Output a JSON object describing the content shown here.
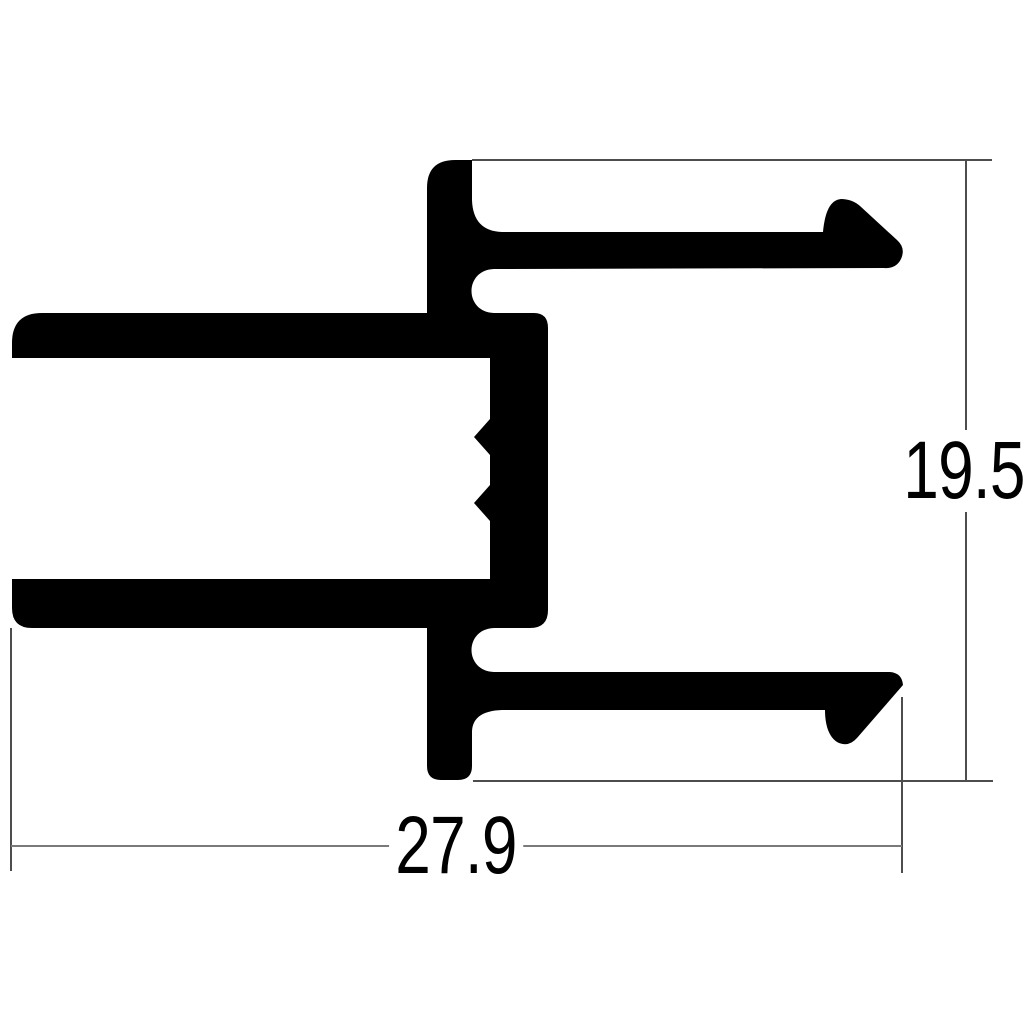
{
  "drawing": {
    "type": "extrusion-profile-cross-section",
    "background_color": "#ffffff",
    "profile_fill_color": "#000000",
    "extension_line_color": "#4d4d4d",
    "dimension_line_color": "#7a7a7a",
    "dimensions": {
      "height": {
        "value": "19.5"
      },
      "width": {
        "value": "27.9"
      }
    }
  }
}
